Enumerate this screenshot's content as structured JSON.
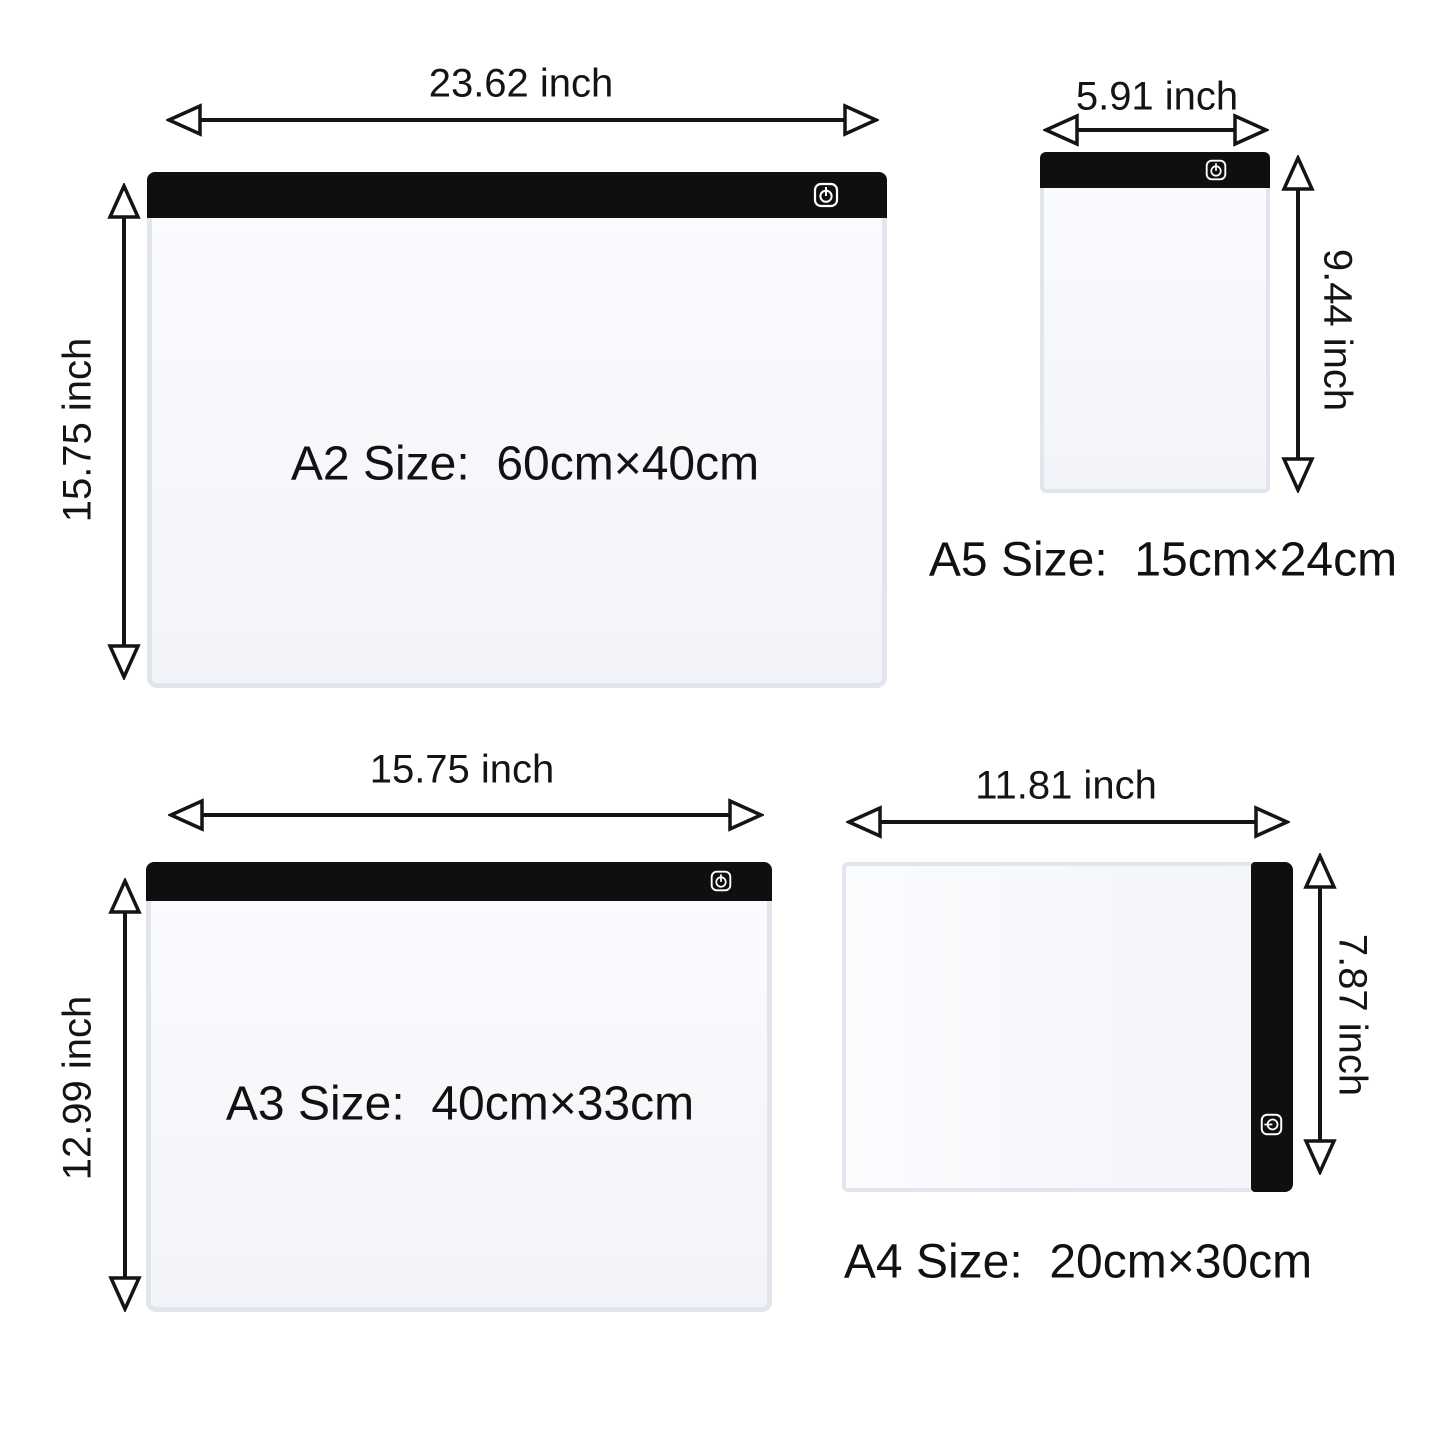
{
  "colors": {
    "background": "#ffffff",
    "ink": "#141414",
    "pad_bar": "#0f0f0f",
    "pad_body": "#f5f7fa",
    "pad_frame": "#e2e5ec"
  },
  "icons": {
    "power_button": "power-icon"
  },
  "panels": {
    "a2": {
      "width_label": "23.62 inch",
      "height_label": "15.75 inch",
      "caption": "A2 Size:  60cm×40cm"
    },
    "a5": {
      "width_label": "5.91 inch",
      "height_label": "9.44 inch",
      "caption": "A5 Size:  15cm×24cm"
    },
    "a3": {
      "width_label": "15.75 inch",
      "height_label": "12.99 inch",
      "caption": "A3 Size:  40cm×33cm"
    },
    "a4": {
      "width_label": "11.81 inch",
      "height_label": "7.87 inch",
      "caption": "A4 Size:  20cm×30cm"
    }
  }
}
